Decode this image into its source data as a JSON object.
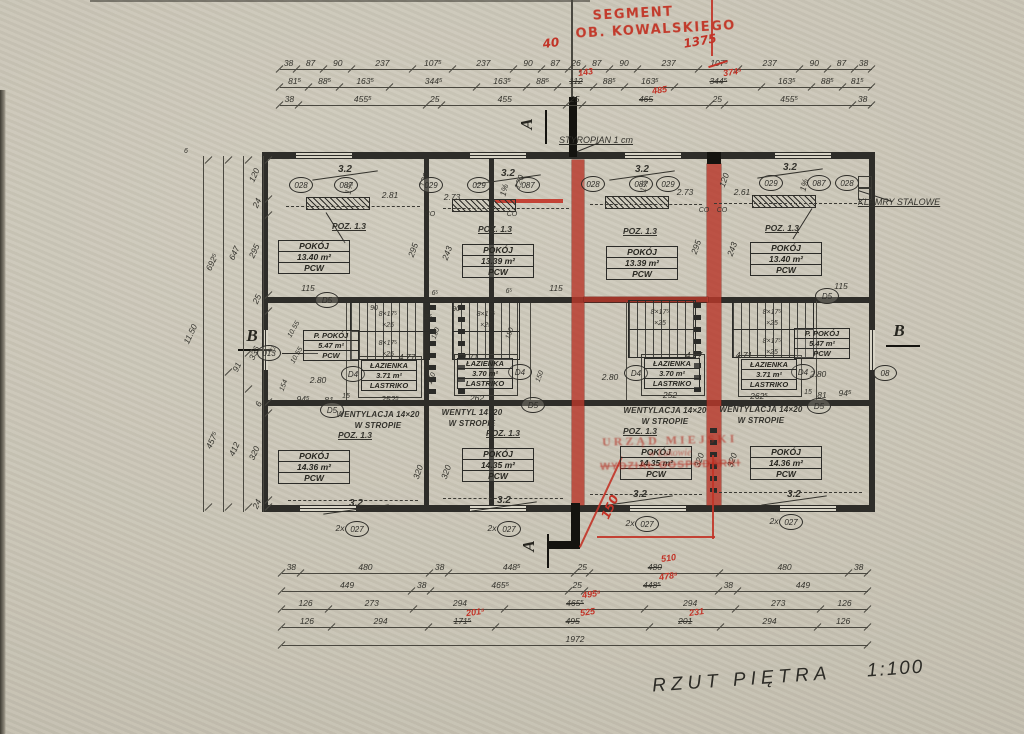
{
  "meta": {
    "title": "RZUT PIĘTRA",
    "scale": "1:100"
  },
  "red_notes": {
    "segment1": "SEGMENT",
    "segment2": "OB. KOWALSKIEGO",
    "stamp": {
      "l1": "URZĄD MIEJSKI",
      "l2": "w Łukowie",
      "l3": "WYDZIAŁ GOSPODARKI"
    }
  },
  "dims": {
    "top1": [
      "38",
      "87",
      "90",
      "237",
      "107⁵",
      "237",
      "90",
      "87",
      "26",
      "87",
      "90",
      "237",
      {
        "t": "107⁵",
        "redstrike": true
      },
      "237",
      "90",
      "87",
      "38"
    ],
    "top2": [
      "81⁵",
      "88⁵",
      "163⁵",
      "344⁵",
      "163⁵",
      "88⁵",
      {
        "t": "112",
        "red": "143"
      },
      "88⁵",
      "163⁵",
      {
        "t": "344⁵",
        "red": "374⁵"
      },
      "163⁵",
      "88⁵",
      "81⁵"
    ],
    "top3": [
      "38",
      "455⁵",
      "25",
      "455",
      "25",
      {
        "t": "465",
        "red": "485"
      },
      "25",
      "455⁵",
      "38"
    ],
    "bottom1": [
      "38",
      "480",
      "38",
      "448⁵",
      "25",
      {
        "t": "480",
        "red": "510"
      },
      "480",
      "38"
    ],
    "bottom2": [
      "449",
      "38",
      "465⁵",
      "25",
      {
        "t": "448⁵",
        "red": "478⁵"
      },
      "38",
      "449"
    ],
    "bottom3": [
      "126",
      "273",
      "294",
      {
        "t": "465⁵",
        "red": "495⁵"
      },
      "294",
      "273",
      "126"
    ],
    "bottom4": [
      "126",
      "294",
      {
        "t": "171⁵",
        "red": "201⁵"
      },
      {
        "t": "495",
        "red": "525"
      },
      {
        "t": "201",
        "red": "231"
      },
      "294",
      "126"
    ],
    "bottom_total": [
      "1972"
    ],
    "left_v1": [
      "120",
      "24",
      "295",
      "25",
      "336",
      "6",
      "320",
      "24"
    ],
    "left_v2": [
      "647",
      "91",
      "412"
    ],
    "left_v3": [
      "692⁵",
      "457⁵"
    ],
    "left_total": [
      "11.50"
    ]
  },
  "plan": {
    "texts": [
      {
        "t": "40",
        "x": 551,
        "y": 36,
        "r": -8,
        "c": "hw red"
      },
      {
        "t": "1375",
        "x": 700,
        "y": 34,
        "r": -10,
        "c": "hw red"
      },
      {
        "t": "STYROPIAN 1 cm",
        "x": 596,
        "y": 135,
        "c": "small u"
      },
      {
        "t": "KLAMRY STALOWE",
        "x": 899,
        "y": 197,
        "c": "small u"
      },
      {
        "t": "A",
        "x": 527,
        "y": 114,
        "r": -90,
        "c": "secletter"
      },
      {
        "t": "A",
        "x": 529,
        "y": 536,
        "r": -90,
        "c": "secletter"
      },
      {
        "t": "B",
        "x": 252,
        "y": 326,
        "c": "secletter"
      },
      {
        "t": "B",
        "x": 899,
        "y": 321,
        "c": "secletter"
      },
      {
        "t": "6",
        "x": 186,
        "y": 148,
        "c": "tiny"
      },
      {
        "t": "3.2",
        "x": 345,
        "y": 164,
        "c": "slope"
      },
      {
        "t": "3.2",
        "x": 508,
        "y": 168,
        "c": "slope"
      },
      {
        "t": "3.2",
        "x": 642,
        "y": 164,
        "c": "slope"
      },
      {
        "t": "3.2",
        "x": 790,
        "y": 162,
        "c": "slope"
      },
      {
        "t": "3.2",
        "x": 356,
        "y": 498,
        "c": "slope"
      },
      {
        "t": "3.2",
        "x": 504,
        "y": 495,
        "c": "slope"
      },
      {
        "t": "3.2",
        "x": 640,
        "y": 489,
        "c": "slope"
      },
      {
        "t": "3.2",
        "x": 794,
        "y": 489,
        "c": "slope"
      },
      {
        "t": "1%",
        "x": 349,
        "y": 183,
        "r": -75,
        "c": "dim"
      },
      {
        "t": "1%",
        "x": 504,
        "y": 185,
        "r": -75,
        "c": "dim"
      },
      {
        "t": "1%",
        "x": 644,
        "y": 181,
        "r": -75,
        "c": "dim"
      },
      {
        "t": "1%",
        "x": 804,
        "y": 180,
        "r": -75,
        "c": "dim"
      },
      {
        "t": "2.81",
        "x": 390,
        "y": 190,
        "c": "dim"
      },
      {
        "t": "2.73",
        "x": 452,
        "y": 192,
        "c": "dim"
      },
      {
        "t": "2.73",
        "x": 685,
        "y": 187,
        "c": "dim"
      },
      {
        "t": "2.61",
        "x": 742,
        "y": 187,
        "c": "dim"
      },
      {
        "t": "120",
        "x": 424,
        "y": 175,
        "r": -70,
        "c": "dim"
      },
      {
        "t": "120",
        "x": 519,
        "y": 177,
        "r": -70,
        "c": "dim"
      },
      {
        "t": "120",
        "x": 724,
        "y": 175,
        "r": -70,
        "c": "dim"
      },
      {
        "t": "POZ. 1.3",
        "x": 349,
        "y": 221,
        "c": "poz"
      },
      {
        "t": "POZ. 1.3",
        "x": 495,
        "y": 224,
        "c": "poz"
      },
      {
        "t": "POZ. 1.3",
        "x": 640,
        "y": 226,
        "c": "poz"
      },
      {
        "t": "POZ. 1.3",
        "x": 782,
        "y": 223,
        "c": "poz"
      },
      {
        "t": "CO",
        "x": 430,
        "y": 211,
        "c": "tiny"
      },
      {
        "t": "CO",
        "x": 512,
        "y": 211,
        "c": "tiny"
      },
      {
        "t": "CO",
        "x": 704,
        "y": 207,
        "c": "tiny"
      },
      {
        "t": "CO",
        "x": 722,
        "y": 207,
        "c": "tiny"
      },
      {
        "t": "295",
        "x": 413,
        "y": 245,
        "r": -70,
        "c": "dim"
      },
      {
        "t": "243",
        "x": 447,
        "y": 248,
        "r": -70,
        "c": "dim"
      },
      {
        "t": "295",
        "x": 696,
        "y": 242,
        "r": -70,
        "c": "dim"
      },
      {
        "t": "243",
        "x": 732,
        "y": 244,
        "r": -70,
        "c": "dim"
      },
      {
        "t": "115",
        "x": 308,
        "y": 283,
        "c": "dim"
      },
      {
        "t": "115",
        "x": 556,
        "y": 283,
        "c": "dim"
      },
      {
        "t": "115",
        "x": 841,
        "y": 281,
        "c": "dim"
      },
      {
        "t": "6⁵",
        "x": 435,
        "y": 290,
        "c": "tiny"
      },
      {
        "t": "6⁵",
        "x": 509,
        "y": 288,
        "c": "tiny"
      },
      {
        "t": "90",
        "x": 374,
        "y": 305,
        "c": "tiny"
      },
      {
        "t": "90",
        "x": 456,
        "y": 306,
        "c": "tiny"
      },
      {
        "t": "25",
        "x": 428,
        "y": 314,
        "c": "tiny"
      },
      {
        "t": "8×17⁵",
        "x": 388,
        "y": 311,
        "c": "tiny"
      },
      {
        "t": "×25",
        "x": 388,
        "y": 322,
        "c": "tiny"
      },
      {
        "t": "8×17⁵",
        "x": 486,
        "y": 311,
        "c": "tiny"
      },
      {
        "t": "×25",
        "x": 486,
        "y": 322,
        "c": "tiny"
      },
      {
        "t": "8×17⁵",
        "x": 660,
        "y": 309,
        "c": "tiny"
      },
      {
        "t": "×25",
        "x": 660,
        "y": 320,
        "c": "tiny"
      },
      {
        "t": "8×17⁵",
        "x": 772,
        "y": 309,
        "c": "tiny"
      },
      {
        "t": "×25",
        "x": 772,
        "y": 320,
        "c": "tiny"
      },
      {
        "t": "8×17⁵",
        "x": 388,
        "y": 340,
        "c": "tiny"
      },
      {
        "t": "×25",
        "x": 388,
        "y": 351,
        "c": "tiny"
      },
      {
        "t": "8×17⁵",
        "x": 772,
        "y": 338,
        "c": "tiny"
      },
      {
        "t": "×25",
        "x": 772,
        "y": 349,
        "c": "tiny"
      },
      {
        "t": "180",
        "x": 436,
        "y": 330,
        "r": -70,
        "c": "tiny"
      },
      {
        "t": "180",
        "x": 510,
        "y": 330,
        "r": -70,
        "c": "tiny"
      },
      {
        "t": "150",
        "x": 432,
        "y": 375,
        "r": -70,
        "c": "tiny"
      },
      {
        "t": "150",
        "x": 540,
        "y": 373,
        "r": -70,
        "c": "tiny"
      },
      {
        "t": "10.55",
        "x": 294,
        "y": 326,
        "r": -60,
        "c": "tiny"
      },
      {
        "t": "91",
        "x": 273,
        "y": 346,
        "r": -60,
        "c": "tiny"
      },
      {
        "t": "10.55",
        "x": 297,
        "y": 352,
        "r": -60,
        "c": "tiny"
      },
      {
        "t": "154",
        "x": 284,
        "y": 382,
        "r": -70,
        "c": "tiny"
      },
      {
        "t": "4.77",
        "x": 407,
        "y": 352,
        "c": "dim"
      },
      {
        "t": "4.71",
        "x": 470,
        "y": 352,
        "c": "dim"
      },
      {
        "t": "4.77",
        "x": 694,
        "y": 350,
        "c": "dim"
      },
      {
        "t": "4.71",
        "x": 744,
        "y": 350,
        "c": "dim"
      },
      {
        "t": "2.80",
        "x": 318,
        "y": 375,
        "c": "dim"
      },
      {
        "t": "2.80",
        "x": 610,
        "y": 372,
        "c": "dim"
      },
      {
        "t": "2.80",
        "x": 818,
        "y": 369,
        "c": "dim"
      },
      {
        "t": "252⁵",
        "x": 390,
        "y": 394,
        "c": "dim"
      },
      {
        "t": "262",
        "x": 477,
        "y": 393,
        "c": "dim"
      },
      {
        "t": "252",
        "x": 670,
        "y": 390,
        "c": "dim"
      },
      {
        "t": "262⁵",
        "x": 759,
        "y": 391,
        "c": "dim"
      },
      {
        "t": "94⁵",
        "x": 303,
        "y": 394,
        "c": "dim"
      },
      {
        "t": "81",
        "x": 329,
        "y": 395,
        "c": "dim"
      },
      {
        "t": "15",
        "x": 346,
        "y": 393,
        "c": "tiny"
      },
      {
        "t": "15",
        "x": 808,
        "y": 389,
        "c": "tiny"
      },
      {
        "t": "81",
        "x": 822,
        "y": 390,
        "c": "dim"
      },
      {
        "t": "94⁵",
        "x": 845,
        "y": 388,
        "c": "dim"
      },
      {
        "t": "WENTYLACJA 14×20",
        "x": 378,
        "y": 410,
        "c": "vent"
      },
      {
        "t": "W STROPIE",
        "x": 378,
        "y": 421,
        "c": "vent"
      },
      {
        "t": "WENTYL 14×20",
        "x": 472,
        "y": 408,
        "c": "vent"
      },
      {
        "t": "W STROPIE",
        "x": 472,
        "y": 419,
        "c": "vent"
      },
      {
        "t": "WENTYLACJA 14×20",
        "x": 665,
        "y": 406,
        "c": "vent"
      },
      {
        "t": "W STROPIE",
        "x": 665,
        "y": 417,
        "c": "vent"
      },
      {
        "t": "WENTYLACJA 14×20",
        "x": 761,
        "y": 405,
        "c": "vent"
      },
      {
        "t": "W STROPIE",
        "x": 761,
        "y": 416,
        "c": "vent"
      },
      {
        "t": "POZ. 1.3",
        "x": 355,
        "y": 430,
        "c": "poz"
      },
      {
        "t": "POZ. 1.3",
        "x": 503,
        "y": 428,
        "c": "poz"
      },
      {
        "t": "POZ. 1.3",
        "x": 640,
        "y": 426,
        "c": "poz"
      },
      {
        "t": "320",
        "x": 418,
        "y": 467,
        "r": -70,
        "c": "dim"
      },
      {
        "t": "320",
        "x": 446,
        "y": 467,
        "r": -70,
        "c": "dim"
      },
      {
        "t": "320",
        "x": 699,
        "y": 455,
        "r": -70,
        "c": "dim"
      },
      {
        "t": "320",
        "x": 732,
        "y": 455,
        "r": -70,
        "c": "dim"
      },
      {
        "t": "2x",
        "x": 340,
        "y": 523,
        "c": "dim"
      },
      {
        "t": "2x",
        "x": 492,
        "y": 523,
        "c": "dim"
      },
      {
        "t": "2x",
        "x": 630,
        "y": 518,
        "c": "dim"
      },
      {
        "t": "2x",
        "x": 774,
        "y": 516,
        "c": "dim"
      },
      {
        "t": "150",
        "x": 610,
        "y": 500,
        "r": -65,
        "c": "hw red"
      }
    ],
    "circles": [
      {
        "t": "028",
        "x": 300,
        "y": 184
      },
      {
        "t": "087",
        "x": 345,
        "y": 184
      },
      {
        "t": "029",
        "x": 430,
        "y": 184
      },
      {
        "t": "029",
        "x": 478,
        "y": 184
      },
      {
        "t": "087",
        "x": 527,
        "y": 184
      },
      {
        "t": "028",
        "x": 592,
        "y": 183
      },
      {
        "t": "087",
        "x": 640,
        "y": 183
      },
      {
        "t": "029",
        "x": 667,
        "y": 183
      },
      {
        "t": "029",
        "x": 770,
        "y": 182
      },
      {
        "t": "087",
        "x": 818,
        "y": 182
      },
      {
        "t": "028",
        "x": 846,
        "y": 182
      },
      {
        "t": "D5",
        "x": 326,
        "y": 299
      },
      {
        "t": "D5",
        "x": 826,
        "y": 295
      },
      {
        "t": "D5",
        "x": 331,
        "y": 409
      },
      {
        "t": "D5",
        "x": 532,
        "y": 404
      },
      {
        "t": "D5",
        "x": 818,
        "y": 405
      },
      {
        "t": "D4",
        "x": 352,
        "y": 373
      },
      {
        "t": "D4",
        "x": 519,
        "y": 371
      },
      {
        "t": "D4",
        "x": 635,
        "y": 372
      },
      {
        "t": "D4",
        "x": 802,
        "y": 371
      },
      {
        "t": "013",
        "x": 268,
        "y": 352
      },
      {
        "t": "08",
        "x": 884,
        "y": 372
      },
      {
        "t": "027",
        "x": 356,
        "y": 528
      },
      {
        "t": "027",
        "x": 508,
        "y": 528
      },
      {
        "t": "027",
        "x": 646,
        "y": 523
      },
      {
        "t": "027",
        "x": 790,
        "y": 521
      }
    ],
    "room_boxes": [
      {
        "x": 278,
        "y": 240,
        "c": "",
        "lines": [
          "POKÓJ",
          "13.40 m²",
          "PCW"
        ]
      },
      {
        "x": 462,
        "y": 244,
        "c": "",
        "lines": [
          "POKÓJ",
          "13.39 m²",
          "PCW"
        ]
      },
      {
        "x": 606,
        "y": 246,
        "c": "",
        "lines": [
          "POKÓJ",
          "13.39 m²",
          "PCW"
        ]
      },
      {
        "x": 750,
        "y": 242,
        "c": "",
        "lines": [
          "POKÓJ",
          "13.40 m²",
          "PCW"
        ]
      },
      {
        "x": 278,
        "y": 450,
        "c": "",
        "lines": [
          "POKÓJ",
          "14.36 m²",
          "PCW"
        ]
      },
      {
        "x": 462,
        "y": 448,
        "c": "",
        "lines": [
          "POKÓJ",
          "14.35 m²",
          "PCW"
        ]
      },
      {
        "x": 620,
        "y": 446,
        "c": "",
        "lines": [
          "POKÓJ",
          "14.35 m²",
          "PCW"
        ]
      },
      {
        "x": 750,
        "y": 446,
        "c": "",
        "lines": [
          "POKÓJ",
          "14.36 m²",
          "PCW"
        ]
      },
      {
        "x": 303,
        "y": 330,
        "c": "sm",
        "lines": [
          "P. POKÓJ",
          "5.47 m²",
          "PCW"
        ]
      },
      {
        "x": 794,
        "y": 328,
        "c": "sm",
        "lines": [
          "P. POKÓJ",
          "5.47 m²",
          "PCW"
        ]
      },
      {
        "x": 361,
        "y": 360,
        "c": "sm",
        "lines": [
          "ŁAZIENKA",
          "3.71 m²",
          "LASTRIKO"
        ]
      },
      {
        "x": 457,
        "y": 358,
        "c": "sm",
        "lines": [
          "ŁAZIENKA",
          "3.70 m²",
          "LASTRIKO"
        ]
      },
      {
        "x": 644,
        "y": 358,
        "c": "sm",
        "lines": [
          "ŁAZIENKA",
          "3.70 m²",
          "LASTRIKO"
        ]
      },
      {
        "x": 741,
        "y": 359,
        "c": "sm",
        "lines": [
          "ŁAZIENKA",
          "3.71 m²",
          "LASTRIKO"
        ]
      }
    ]
  }
}
